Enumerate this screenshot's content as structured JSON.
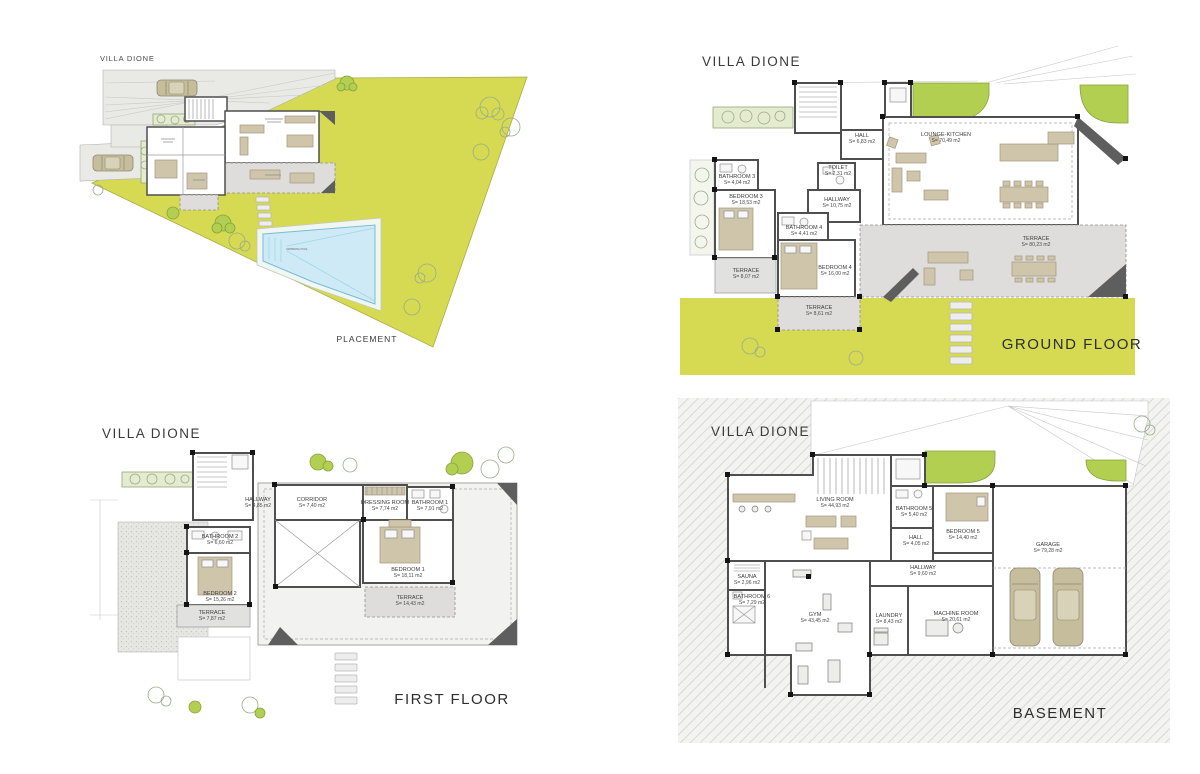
{
  "project": {
    "name": "VILLA DIONE"
  },
  "colors": {
    "lot_green": "#d6da52",
    "tree_green": "#b3cf52",
    "wall_gray": "#4f4f4f",
    "terrace_gray": "#e1e1df",
    "furniture_tan": "#cfc5aa",
    "pool_blue": "#cdeaf6",
    "text": "#3c3c3c"
  },
  "panels": {
    "placement": {
      "title": "VILLA DIONE",
      "caption": "PLACEMENT",
      "pool_label": "SWIMMING POOL"
    },
    "ground": {
      "title": "VILLA DIONE",
      "caption": "GROUND FLOOR",
      "rooms": [
        {
          "name": "HALL",
          "area": "S= 6,83 m2"
        },
        {
          "name": "LOUNGE-KITCHEN",
          "area": "S= 70,49 m2"
        },
        {
          "name": "TOILET",
          "area": "S= 2,31 m2"
        },
        {
          "name": "BATHROOM 3",
          "area": "S= 4,04 m2"
        },
        {
          "name": "BEDROOM 3",
          "area": "S= 18,53 m2"
        },
        {
          "name": "HALLWAY",
          "area": "S= 10,75 m2"
        },
        {
          "name": "BATHROOM 4",
          "area": "S= 4,41 m2"
        },
        {
          "name": "BEDROOM 4",
          "area": "S= 16,00 m2"
        },
        {
          "name": "TERRACE",
          "area": "S= 8,07 m2"
        },
        {
          "name": "TERRACE",
          "area": "S= 8,61 m2"
        },
        {
          "name": "TERRACE",
          "area": "S= 80,23 m2"
        }
      ]
    },
    "first": {
      "title": "VILLA DIONE",
      "caption": "FIRST FLOOR",
      "rooms": [
        {
          "name": "HALLWAY",
          "area": "S= 4,85 m2"
        },
        {
          "name": "CORRIDOR",
          "area": "S= 7,40 m2"
        },
        {
          "name": "DRESSING ROOM",
          "area": "S= 7,74 m2"
        },
        {
          "name": "BATHROOM 1",
          "area": "S= 7,91 m2"
        },
        {
          "name": "BATHROOM 2",
          "area": "S= 6,60 m2"
        },
        {
          "name": "BEDROOM 2",
          "area": "S= 15,26 m2"
        },
        {
          "name": "BEDROOM 1",
          "area": "S= 18,11 m2"
        },
        {
          "name": "TERRACE",
          "area": "S= 7,87 m2"
        },
        {
          "name": "TERRACE",
          "area": "S= 14,43 m2"
        }
      ]
    },
    "basement": {
      "title": "VILLA DIONE",
      "caption": "BASEMENT",
      "rooms": [
        {
          "name": "LIVING ROOM",
          "area": "S= 44,93 m2"
        },
        {
          "name": "BATHROOM 5",
          "area": "S= 5,40 m2"
        },
        {
          "name": "HALL",
          "area": "S= 4,05 m2"
        },
        {
          "name": "BEDROOM 5",
          "area": "S= 14,40 m2"
        },
        {
          "name": "GARAGE",
          "area": "S= 79,28 m2"
        },
        {
          "name": "SAUNA",
          "area": "S= 2,96 m2"
        },
        {
          "name": "BATHROOM 6",
          "area": "S= 7,29 m2"
        },
        {
          "name": "GYM",
          "area": "S= 43,45 m2"
        },
        {
          "name": "HALLWAY",
          "area": "S= 9,60 m2"
        },
        {
          "name": "LAUNDRY",
          "area": "S= 8,43 m2"
        },
        {
          "name": "MACHINE ROOM",
          "area": "S= 20,61 m2"
        }
      ]
    }
  }
}
